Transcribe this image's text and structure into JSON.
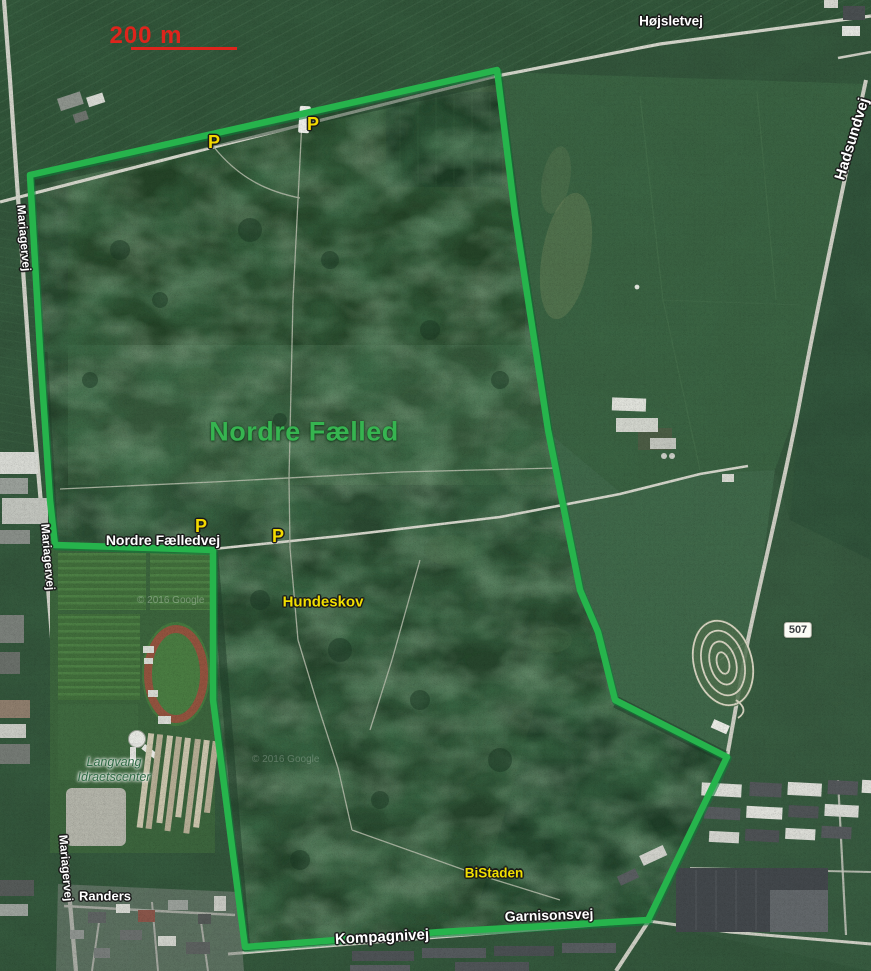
{
  "labels": {
    "hojsletvej": "Højsletvej",
    "hadsundvej": "Hadsundvej",
    "mariagervej_top": "Mariagervej",
    "mariagervej_mid": "Mariagervej",
    "mariagervej_bottom": "Mariagervej",
    "nordre_faelledvej": "Nordre Fælledvej",
    "kompagnivej": "Kompagnivej",
    "garnisonsvej": "Garnisonsvej",
    "nordre_faelled": "Nordre Fælled",
    "hundeskov": "Hundeskov",
    "bistaden": "BiStaden",
    "randers": "Randers",
    "langvang_line1": "Langvang",
    "langvang_line2": "Idraetscenter",
    "route_507": "507",
    "scale": "200 m",
    "watermark": "© 2016 Google"
  },
  "markers": {
    "parking": [
      {
        "label": "P"
      },
      {
        "label": "P"
      },
      {
        "label": "P"
      },
      {
        "label": "P"
      }
    ]
  },
  "colors": {
    "boundary_green": "#26b44c",
    "area_label_green": "#36b450",
    "poi_yellow": "#f0de00",
    "scale_red": "#de241c"
  }
}
